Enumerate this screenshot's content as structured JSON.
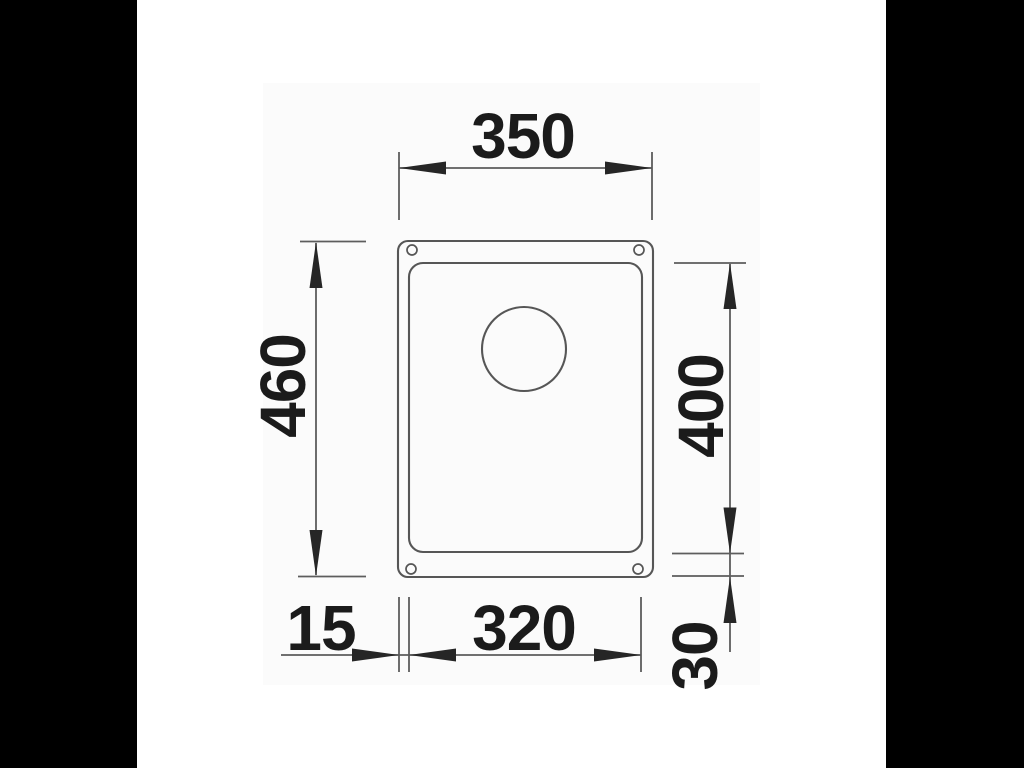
{
  "drawing": {
    "kind": "technical-dimension-drawing",
    "subject": "undermount-sink-top-view",
    "unit": "mm",
    "labels": {
      "overall_width": "350",
      "overall_depth": "460",
      "bowl_depth": "400",
      "rim_left": "15",
      "bowl_width": "320",
      "rim_bottom": "30"
    },
    "colors": {
      "letterbox": "#000000",
      "canvas": "#ffffff",
      "plate": "#fbfbfb",
      "line": "#5d5d5d",
      "text": "#1b1b1b"
    }
  }
}
